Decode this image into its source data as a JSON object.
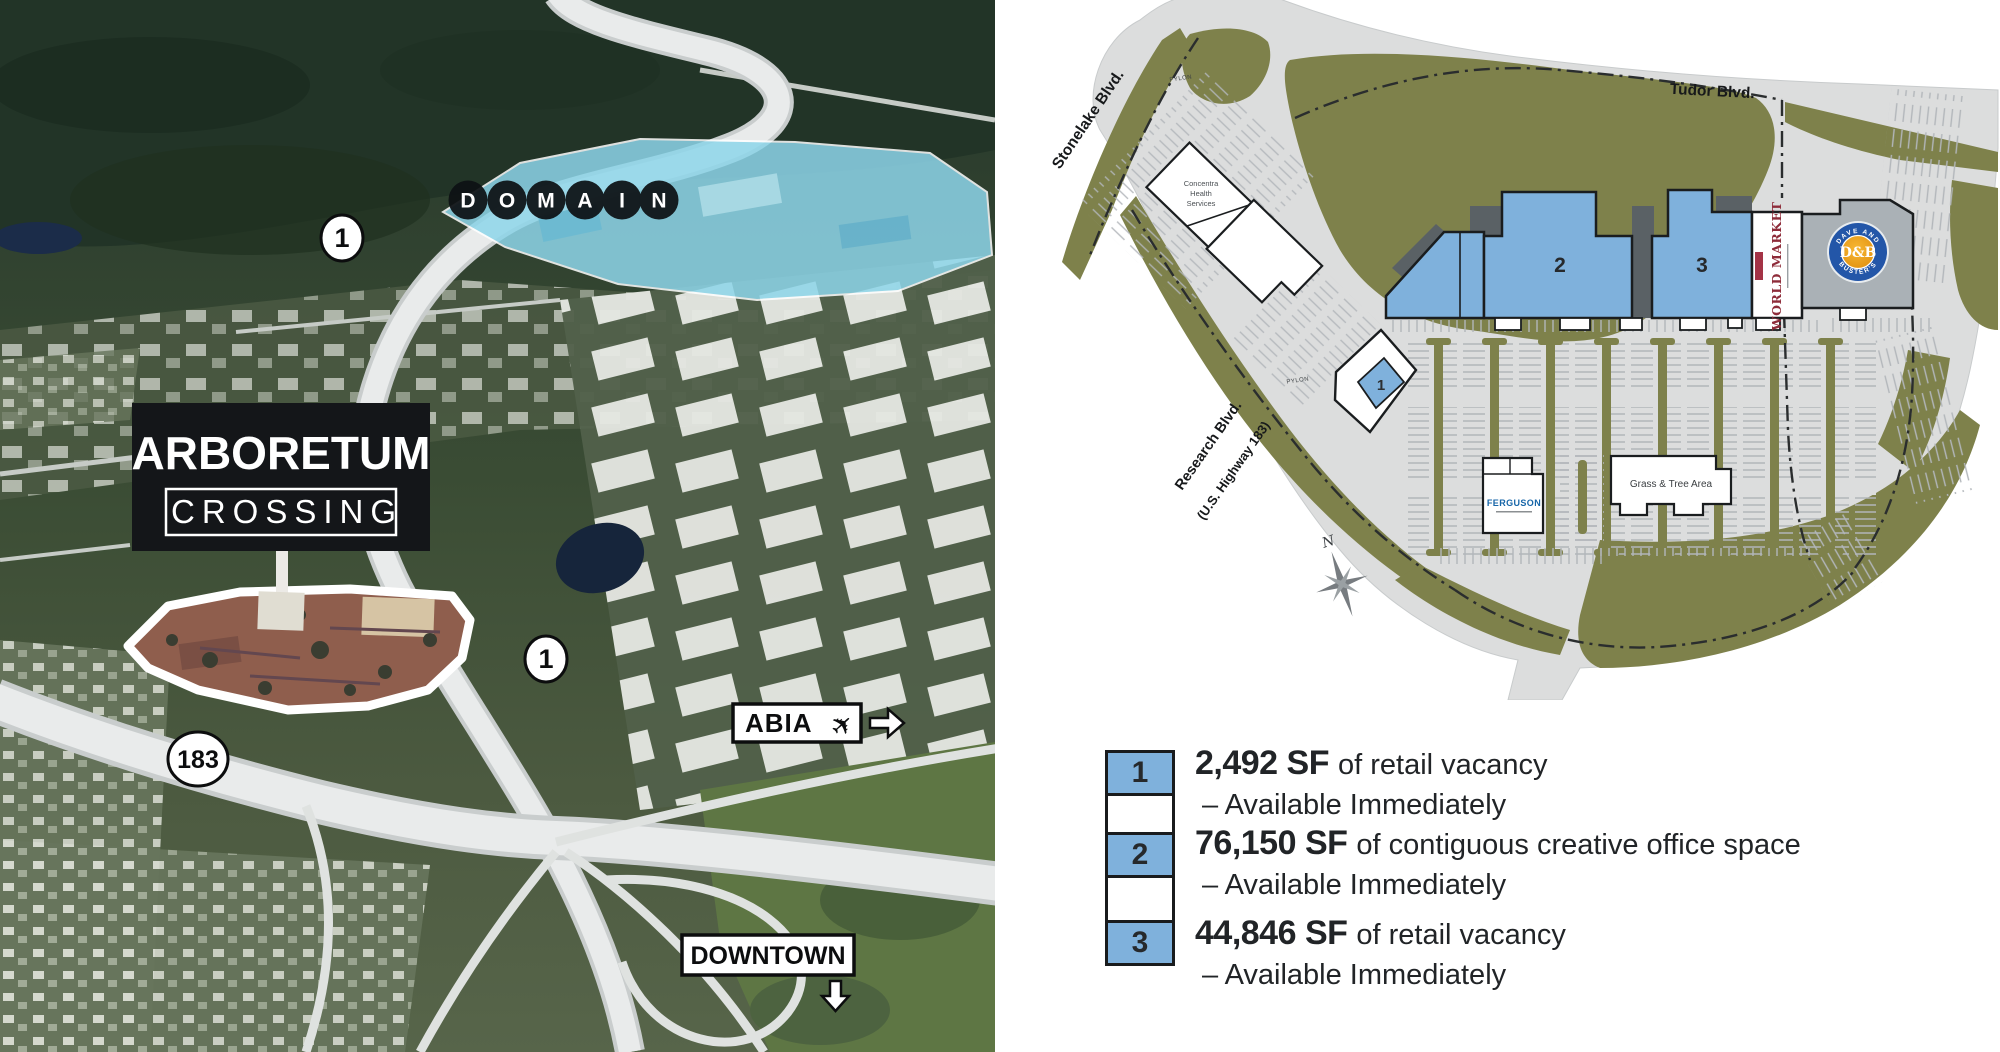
{
  "left_photo": {
    "sign": {
      "line1": "ARBORETUM",
      "line2": "CROSSING"
    },
    "domain_letters": [
      "D",
      "O",
      "M",
      "A",
      "I",
      "N"
    ],
    "shield_loop1": "1",
    "shield_183": "183",
    "abia_label": "ABIA",
    "downtown_label": "DOWNTOWN"
  },
  "site_plan": {
    "streets": {
      "stonelake": "Stonelake Blvd.",
      "tudor": "Tudor Blvd.",
      "research_line1": "Research Blvd.",
      "research_line2": "(U.S. Highway 183)"
    },
    "pylon": "PYLON",
    "compass_n": "N",
    "buildings": {
      "concentra_line1": "Concentra",
      "concentra_line2": "Health",
      "concentra_line3": "Services",
      "b1": "1",
      "b2": "2",
      "b3": "3",
      "world_market": "WORLD MARKET",
      "dnb_top": "DAVE AND",
      "dnb_center": "D&B",
      "dnb_bottom": "BUSTER'S",
      "ferguson": "FERGUSON",
      "grass": "Grass & Tree Area"
    }
  },
  "legend": {
    "items": [
      {
        "num": "1",
        "sf": "2,492 SF",
        "desc": "of retail vacancy",
        "avail": "– Available Immediately"
      },
      {
        "num": "2",
        "sf": "76,150 SF",
        "desc": "of contiguous creative office space",
        "avail": "– Available Immediately"
      },
      {
        "num": "3",
        "sf": "44,846 SF",
        "desc": "of retail vacancy",
        "avail": "– Available Immediately"
      }
    ]
  },
  "colors": {
    "blue": "#7fb1dc",
    "olive": "#7e814b",
    "pavement": "#dcdddd",
    "tick": "#b2b6ba",
    "maroon": "#8e2c3a",
    "dnb_blue": "#2356a8",
    "dnb_orange": "#e8920c",
    "sign_black": "#141619",
    "legend_text": "#212427"
  }
}
